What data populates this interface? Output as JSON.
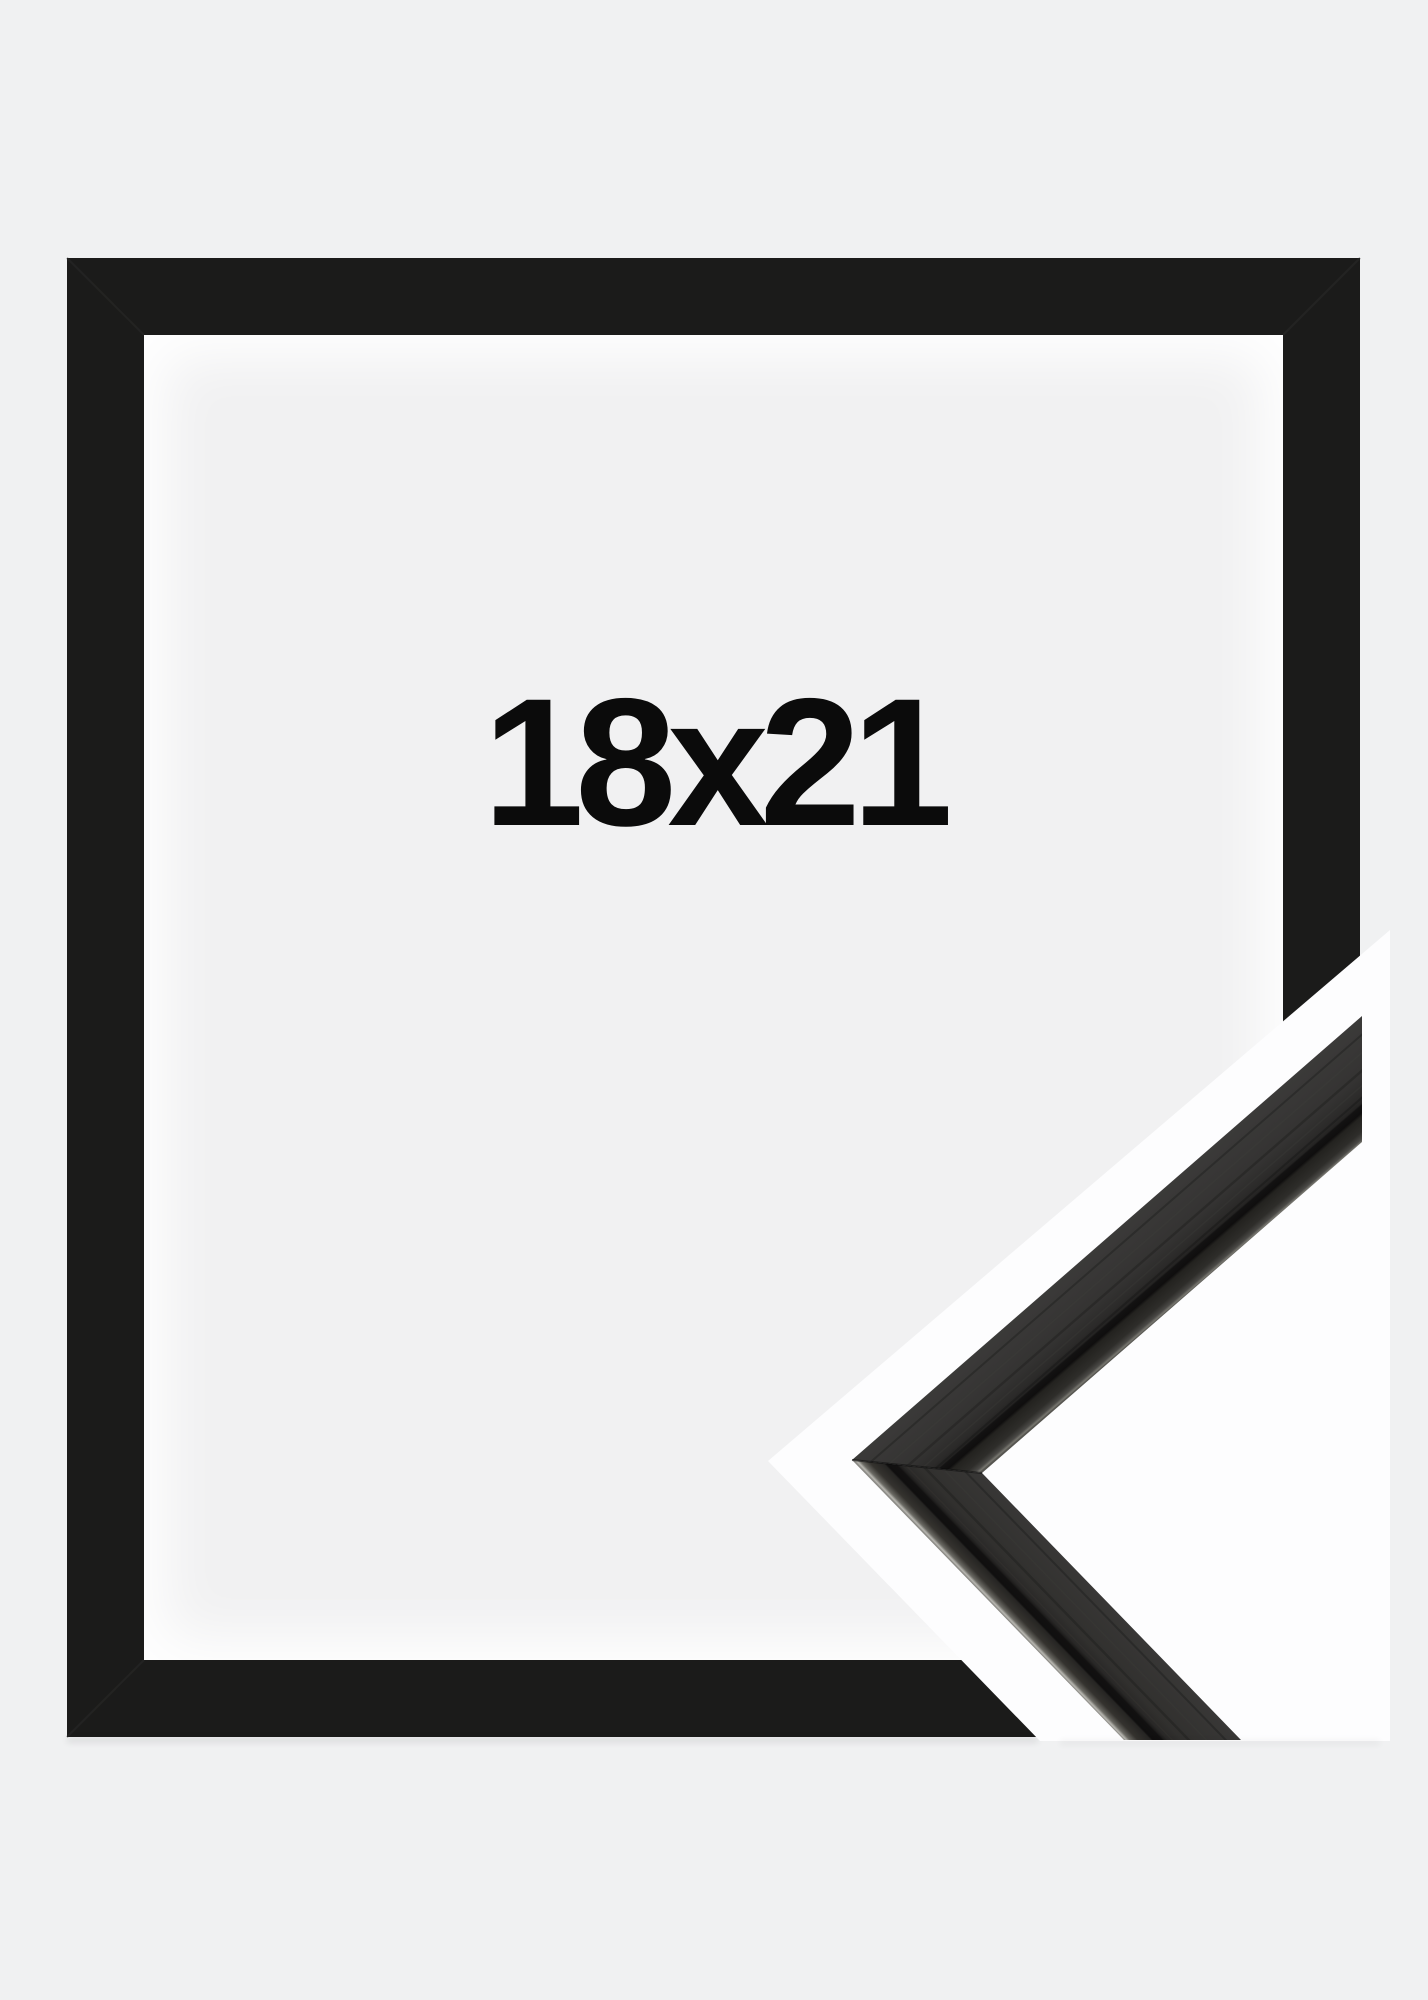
{
  "product": {
    "size_label": "18x21"
  },
  "colors": {
    "background": "#f0f1f2",
    "frame": "#1b1b1a",
    "backdrop_white": "#fdfdfe",
    "label_text": "#0b0b0b",
    "sample_face": "#343332",
    "sample_groove": "#100f0f",
    "sample_edge_highlight": "#b9b8b2"
  }
}
